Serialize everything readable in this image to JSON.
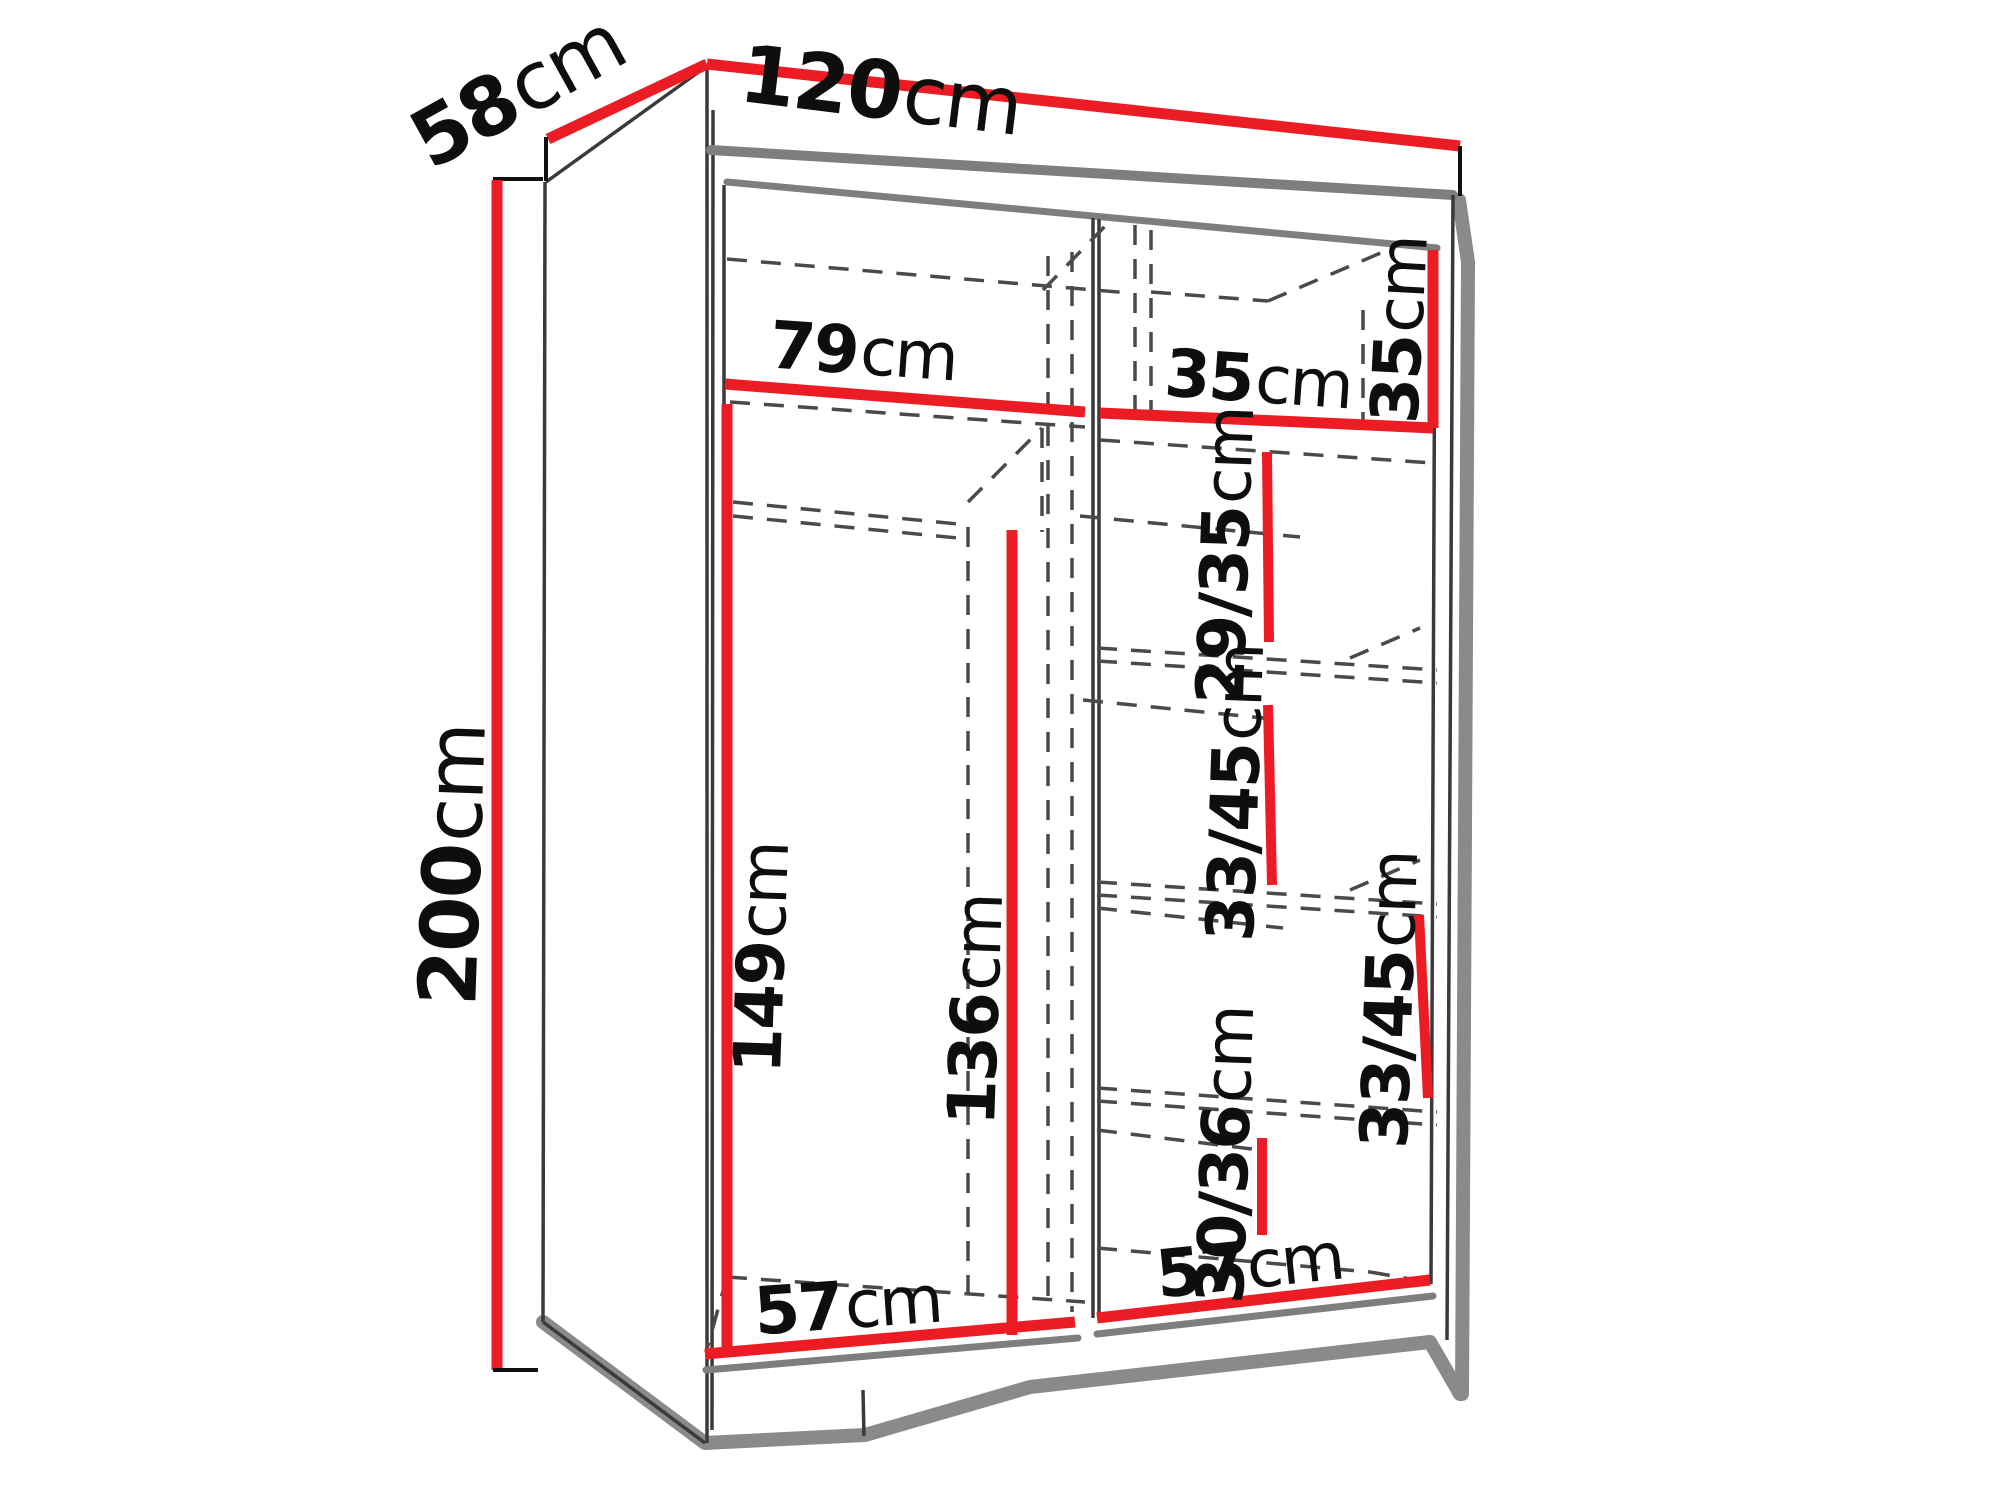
{
  "diagram": {
    "kind": "furniture-dimension-diagram",
    "subject": "two-door sliding wardrobe with internal shelf dimensions",
    "units": "cm"
  },
  "colors": {
    "dimension_red": "#ec1c24",
    "outline_gray": "#7e7e7e",
    "line_dark": "#3a3a3a",
    "label_black": "#0e0e0e",
    "background": "#ffffff"
  },
  "labels": {
    "depth": {
      "num": "58",
      "unit": "cm"
    },
    "width": {
      "num": "120",
      "unit": "cm"
    },
    "height": {
      "num": "200",
      "unit": "cm"
    },
    "top_shelf_left": {
      "num": "79",
      "unit": "cm"
    },
    "top_shelf_right": {
      "num": "35",
      "unit": "cm"
    },
    "top_right_height": {
      "num": "35",
      "unit": "cm"
    },
    "upper_right_cubby": {
      "num": "29/35",
      "unit": "cm"
    },
    "mid_right_cubby": {
      "num": "33/45",
      "unit": "cm"
    },
    "right_wall_cubby": {
      "num": "33/45",
      "unit": "cm"
    },
    "hanging_space": {
      "num": "149",
      "unit": "cm"
    },
    "door_frame": {
      "num": "136",
      "unit": "cm"
    },
    "lower_right_cubby": {
      "num": "30/36",
      "unit": "cm"
    },
    "floor_left": {
      "num": "57",
      "unit": "cm"
    },
    "floor_right": {
      "num": "57",
      "unit": "cm"
    }
  }
}
